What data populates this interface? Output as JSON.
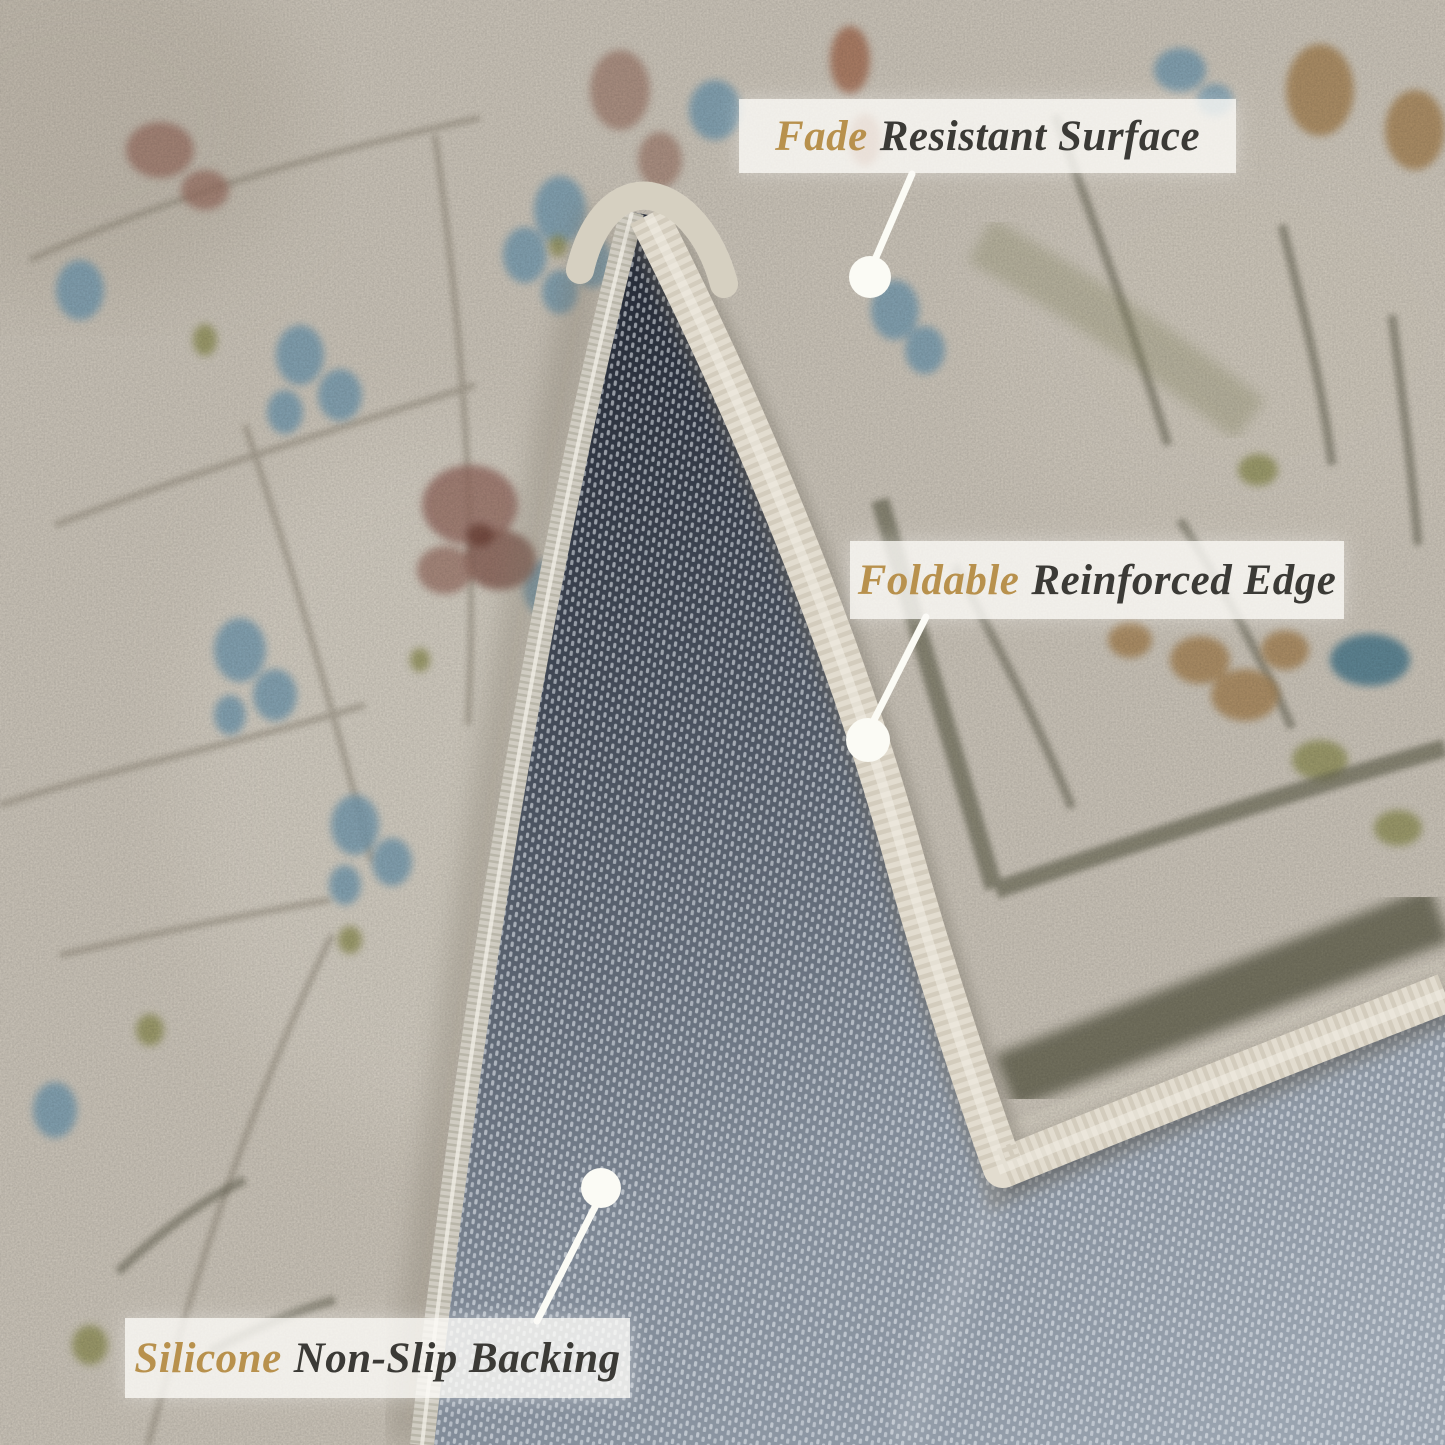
{
  "image_description": "Product close-up photo of a vintage oriental-style rug with its corner folded over, annotated with three feature callouts",
  "colors": {
    "accent_gold": "#b8914d",
    "label_text": "#3b3a36",
    "label_background": "rgba(252,251,247,0.80)",
    "callout_marker_white": "#fbfbf5",
    "rug_surface_cream": "#d3ccc0",
    "rug_backing_dark": "#3f4654",
    "rug_backing_light": "#9aa4b0",
    "binding_cream": "#e2dccf"
  },
  "callouts": [
    {
      "name": "fade-resistant-surface",
      "highlight": "Fade",
      "rest": "Resistant Surface"
    },
    {
      "name": "foldable-reinforced-edge",
      "highlight": "Foldable",
      "rest": "Reinforced Edge"
    },
    {
      "name": "silicone-non-slip-backing",
      "highlight": "Silicone",
      "rest": "Non-Slip Backing"
    }
  ]
}
